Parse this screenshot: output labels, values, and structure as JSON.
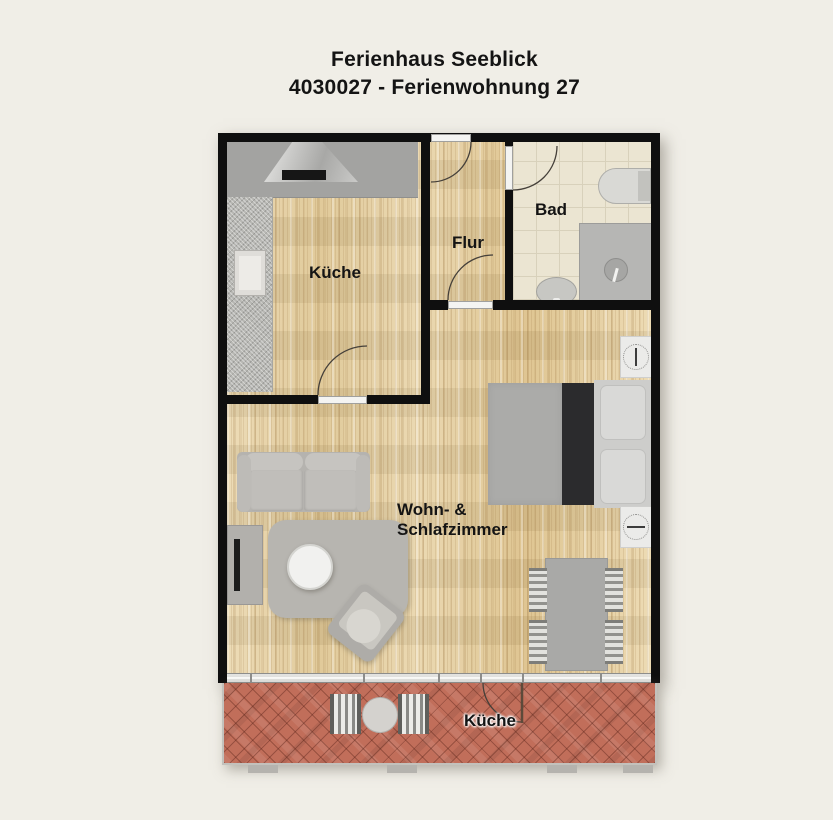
{
  "title": {
    "line1": "Ferienhaus Seeblick",
    "line2": "4030027 - Ferienwohnung 27"
  },
  "rooms": {
    "kitchen": {
      "label": "Küche"
    },
    "hall": {
      "label": "Flur"
    },
    "bath": {
      "label": "Bad"
    },
    "living": {
      "label_line1": "Wohn- &",
      "label_line2": "Schlafzimmer"
    },
    "terrace": {
      "label": "Küche"
    }
  },
  "colors": {
    "background": "#f0eee7",
    "text": "#141414",
    "wall": "#0f0f0f",
    "wood": "#e6d2a9",
    "tile": "#ebe5d2",
    "brick": "#c16e5a",
    "counter": "#a3a3a1",
    "furniture": "#b5b3af",
    "bed_runner": "#2b2b2d",
    "window_band": "#dcdcda",
    "door_arc": "#45403a"
  }
}
